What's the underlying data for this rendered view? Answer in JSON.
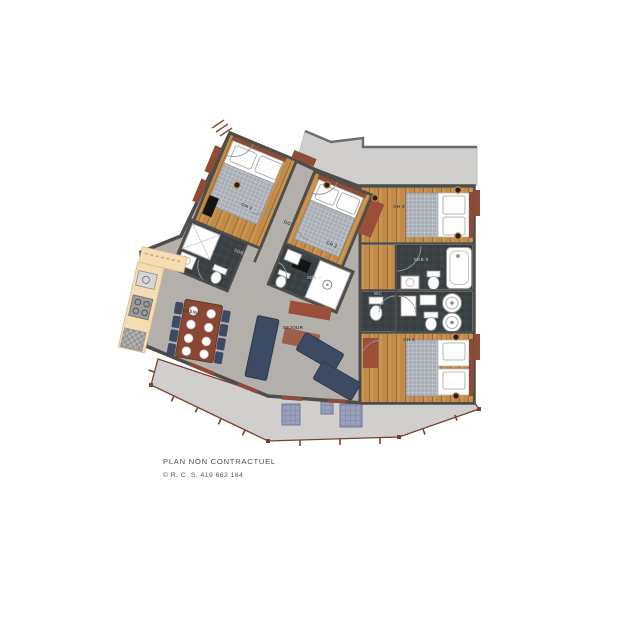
{
  "plan": {
    "labels": {
      "ch1": "CH 1",
      "ch2": "CH 2",
      "ch3": "CH 3",
      "ch4": "CH 4",
      "dgt": "DGT",
      "sejour": "SEJOUR",
      "cuisine": "CUISINE",
      "sdb1": "SDB 1",
      "sdb2": "SDB 2",
      "sdb3": "SDB 3",
      "wc": "WC"
    },
    "palette": {
      "wall": "#4f4d4a",
      "floor_gray": "#b3b0ab",
      "wood": "#c38c49",
      "slate": "#3a4145",
      "terrace_gray": "#d0cfcd",
      "railing_brown": "#7a4130",
      "rust_accent": "#9c4f38",
      "sofa_navy": "#3d4a63",
      "kitchen_cream": "#f6dcb2",
      "fixture_white": "#ffffff"
    }
  },
  "footer": {
    "disclaimer": "PLAN NON CONTRACTUEL",
    "registration": "© R. C. S. 419 662 184"
  }
}
